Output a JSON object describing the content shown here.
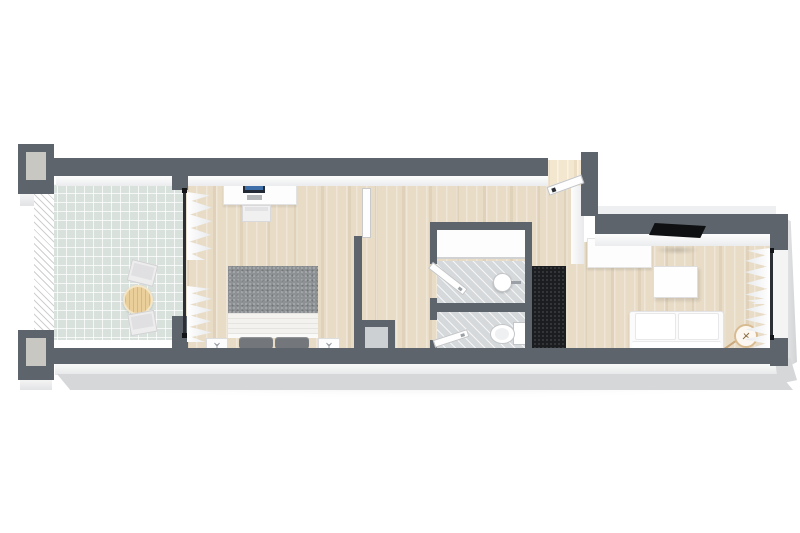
{
  "scene": {
    "type": "floorplan-3d",
    "rooms": [
      {
        "name": "balcony",
        "floor": "tile"
      },
      {
        "name": "bedroom",
        "floor": "wood"
      },
      {
        "name": "hallway",
        "floor": "wood"
      },
      {
        "name": "shower-room",
        "floor": "tile"
      },
      {
        "name": "wc",
        "floor": "tile"
      },
      {
        "name": "living-room",
        "floor": "wood"
      }
    ],
    "furniture": [
      "patio-table",
      "patio-chair",
      "patio-chair",
      "desk",
      "desk-chair",
      "monitor",
      "double-bed",
      "nightstand",
      "nightstand",
      "built-in-closet",
      "round-sink",
      "toilet",
      "dark-wardrobe",
      "entry-door",
      "sideboard",
      "tv",
      "coffee-table",
      "sofa",
      "plant-pot",
      "curtains",
      "glass-wall",
      "window"
    ]
  },
  "palette": {
    "wall": "#5e646c",
    "outer": "#d6d7d9",
    "wood": "#e8dcc6",
    "tile-balcony": "#d9e1dd",
    "tile-bath": "#d6d9db",
    "duvet": "#8e9194",
    "pillow": "#73767a",
    "dark-cabinet": "#1b1d20",
    "tan": "#ebcf9b",
    "glass": "#2c3035",
    "plant-ring": "#d9bb92"
  }
}
